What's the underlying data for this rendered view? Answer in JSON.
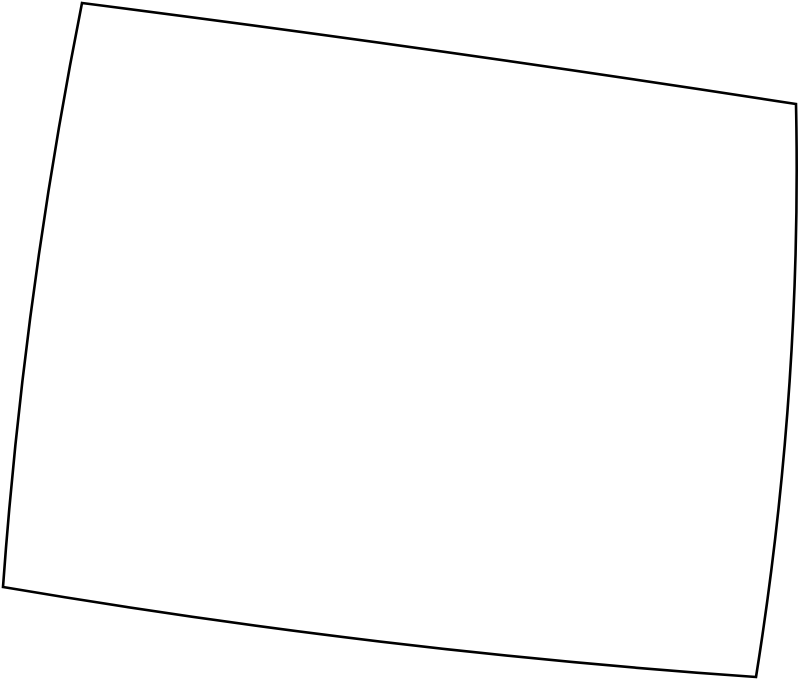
{
  "map": {
    "region_name": "Wyoming",
    "description": "State outline map, black border on white background",
    "viewbox": "0 0 800 683",
    "path": "M 82 3 Q 441 49 796 104 Q 802 390 756 677 Q 380 651 3 587 Q 24 295 82 3 Z",
    "stroke_color": "#000000",
    "fill_color": "#ffffff",
    "stroke_width": "2.6",
    "corners": {
      "top_left": [
        82,
        3
      ],
      "top_right": [
        796,
        104
      ],
      "bottom_right": [
        756,
        677
      ],
      "bottom_left": [
        3,
        587
      ]
    }
  }
}
